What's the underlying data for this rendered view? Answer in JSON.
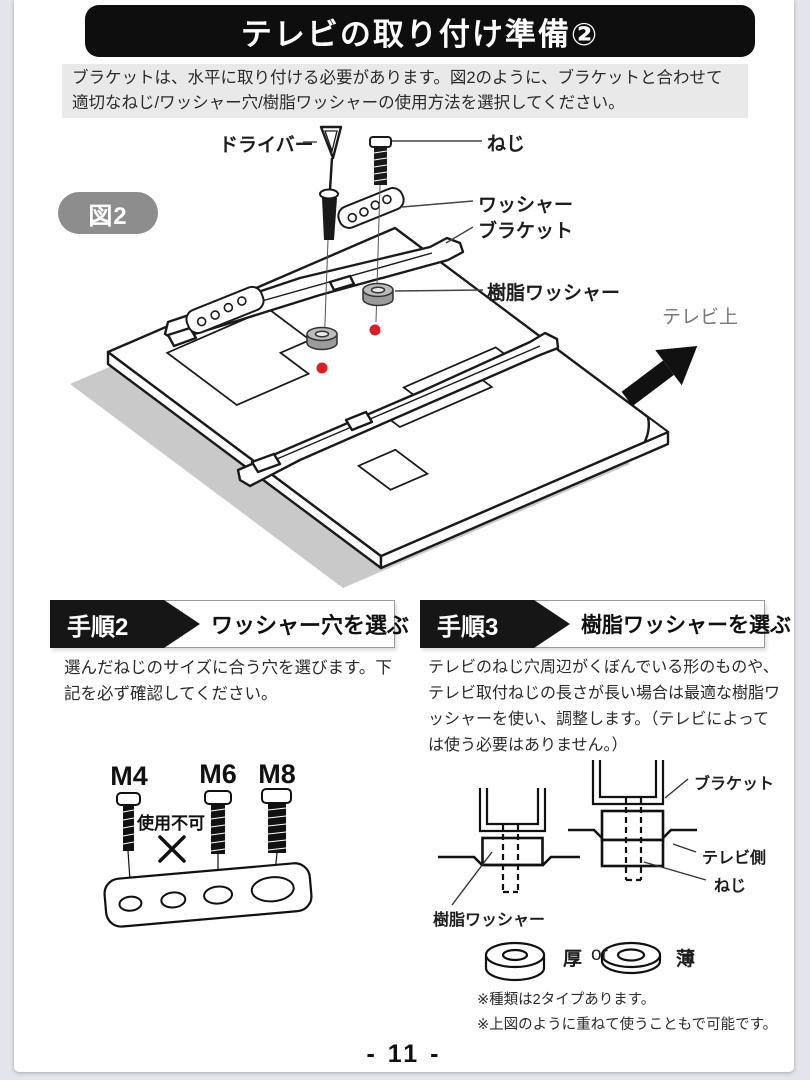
{
  "page": {
    "title": "テレビの取り付け準備②",
    "intro": "ブラケットは、水平に取り付ける必要があります。図2のように、ブラケットと合わせて適切なねじ/ワッシャー穴/樹脂ワッシャーの使用方法を選択してください。",
    "page_number": "- 11 -"
  },
  "figure2": {
    "badge": "図2",
    "labels": {
      "driver": "ドライバー",
      "screw": "ねじ",
      "washer": "ワッシャー",
      "bracket": "ブラケット",
      "resin_washer": "樹脂ワッシャー",
      "tv_top": "テレビ上"
    }
  },
  "step2": {
    "badge": "手順2",
    "title": "ワッシャー穴を選ぶ",
    "body": "選んだねじのサイズに合う穴を選びます。下記を必ず確認してください。",
    "diagram": {
      "sizes": [
        "M4",
        "M6",
        "M8"
      ],
      "unusable": "使用不可"
    }
  },
  "step3": {
    "badge": "手順3",
    "title": "樹脂ワッシャーを選ぶ",
    "body": "テレビのねじ穴周辺がくぼんでいる形のものや、テレビ取付ねじの長さが長い場合は最適な樹脂ワッシャーを使い、調整します。（テレビによっては使う必要はありません。）",
    "diagram_labels": {
      "bracket": "ブラケット",
      "tv_side": "テレビ側",
      "screw": "ねじ",
      "resin_washer": "樹脂ワッシャー"
    },
    "washer_types": {
      "thick": "厚",
      "or": "or",
      "thin": "薄"
    },
    "notes": [
      "※種類は2タイプあります。",
      "※上図のように重ねて使うこともで可能です。"
    ]
  },
  "colors": {
    "hole_marker_red": "#d81f26",
    "banner_black": "#0e0e0e",
    "figure_badge_gray": "#8d8d8d"
  }
}
